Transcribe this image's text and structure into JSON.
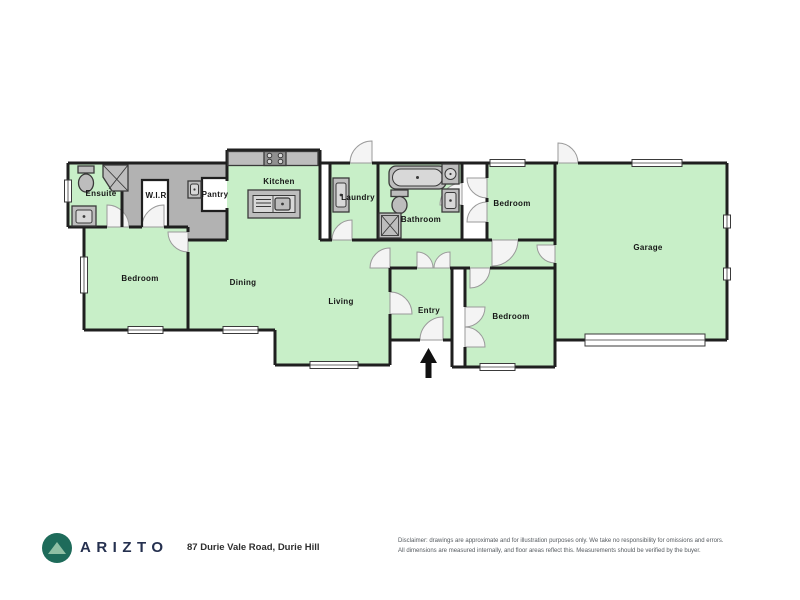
{
  "plan": {
    "labels": {
      "ensuite": "Ensuite",
      "wir": "W.I.R",
      "pantry": "Pantry",
      "kitchen": "Kitchen",
      "laundry": "Laundry",
      "bathroom": "Bathroom",
      "bedroom_top_right": "Bedroom",
      "garage": "Garage",
      "bedroom_left": "Bedroom",
      "dining": "Dining",
      "living": "Living",
      "entry": "Entry",
      "bedroom_bottom_right": "Bedroom"
    },
    "icons": {
      "entry_arrow": "up-arrow",
      "logo": "mountain-in-circle"
    }
  },
  "footer": {
    "brand": "ARIZTO",
    "address": "87 Durie Vale Road, Durie Hill",
    "disclaimer_line1": "Disclaimer: drawings are approximate and for illustration purposes only. We take no responsibility for omissions and errors.",
    "disclaimer_line2": "All dimensions are measured internally, and floor areas reflect this. Measurements should be verified by the buyer."
  },
  "colors": {
    "room_fill": "#c8efc8",
    "wall": "#1f1f1f",
    "storage_gray": "#b2b2b2",
    "fixture_gray": "#bdbdbd",
    "brand_navy": "#25304f",
    "logo_teal": "#1e6b5a",
    "logo_mountain": "#8fbfa4"
  }
}
